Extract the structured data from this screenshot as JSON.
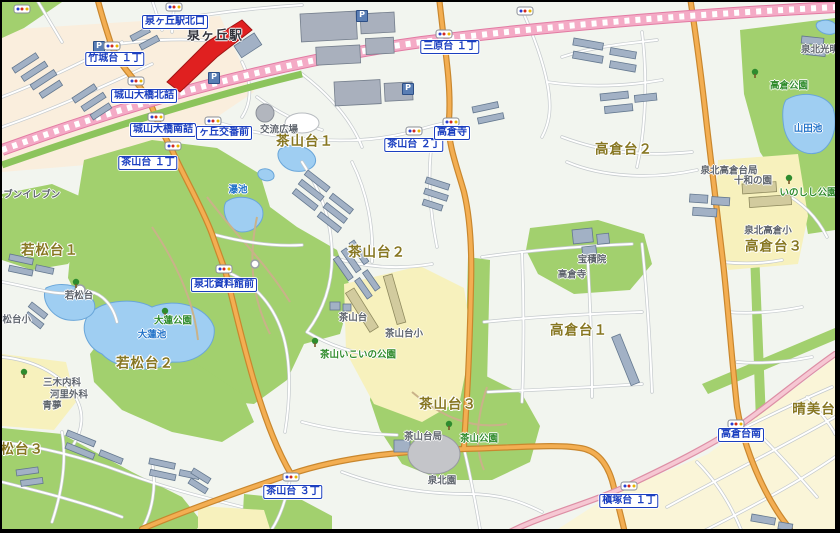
{
  "map": {
    "colors": {
      "label_blue": "#1b3fc0",
      "district_olive": "#877722",
      "park_green": "#2f8b2b",
      "water_blue": "#2273c9",
      "road_orange": "#f3ae52",
      "rail_pink": "#f4abc6",
      "station_red": "#e02020"
    },
    "parking_glyph": "P",
    "stations": [
      {
        "t": "泉ヶ丘駅",
        "x": 213,
        "y": 34
      }
    ],
    "intersections": [
      {
        "t": "泉ヶ丘駅北口",
        "x": 173,
        "y": 20
      },
      {
        "t": "竹城台 １丁",
        "x": 113,
        "y": 57
      },
      {
        "t": "城山大橋北詰",
        "x": 142,
        "y": 94
      },
      {
        "t": "城山大橋南詰",
        "x": 161,
        "y": 128
      },
      {
        "t": "ヶ丘交番前",
        "x": 222,
        "y": 131
      },
      {
        "t": "茶山台 １丁",
        "x": 146,
        "y": 161
      },
      {
        "t": "三原台 １丁",
        "x": 448,
        "y": 45
      },
      {
        "t": "茶山台 ２丁",
        "x": 412,
        "y": 143
      },
      {
        "t": "高倉寺",
        "x": 450,
        "y": 131
      },
      {
        "t": "泉北資料館前",
        "x": 222,
        "y": 283
      },
      {
        "t": "茶山台 ３丁",
        "x": 291,
        "y": 490
      },
      {
        "t": "槇塚台 １丁",
        "x": 627,
        "y": 499
      },
      {
        "t": "高倉台南",
        "x": 739,
        "y": 433
      }
    ],
    "signals": [
      {
        "x": 20,
        "y": 7
      },
      {
        "x": 172,
        "y": 5
      },
      {
        "x": 110,
        "y": 44
      },
      {
        "x": 134,
        "y": 79
      },
      {
        "x": 154,
        "y": 115
      },
      {
        "x": 211,
        "y": 119
      },
      {
        "x": 171,
        "y": 144
      },
      {
        "x": 442,
        "y": 32
      },
      {
        "x": 523,
        "y": 9
      },
      {
        "x": 412,
        "y": 129
      },
      {
        "x": 449,
        "y": 120
      },
      {
        "x": 222,
        "y": 267
      },
      {
        "x": 289,
        "y": 475
      },
      {
        "x": 627,
        "y": 484
      },
      {
        "x": 734,
        "y": 422
      }
    ],
    "districts": [
      {
        "t": "茶山台１",
        "x": 303,
        "y": 140
      },
      {
        "t": "茶山台２",
        "x": 375,
        "y": 251
      },
      {
        "t": "茶山台３",
        "x": 446,
        "y": 403
      },
      {
        "t": "高倉台２",
        "x": 622,
        "y": 148
      },
      {
        "t": "高倉台１",
        "x": 577,
        "y": 329
      },
      {
        "t": "高倉台３",
        "x": 772,
        "y": 245
      },
      {
        "t": "若松台１",
        "x": 48,
        "y": 249
      },
      {
        "t": "若松台２",
        "x": 143,
        "y": 362
      },
      {
        "t": "若松台３",
        "x": 13,
        "y": 448
      },
      {
        "t": "晴美台",
        "x": 812,
        "y": 408
      }
    ],
    "facilities": [
      {
        "t": "交流広場",
        "x": 277,
        "y": 128
      },
      {
        "t": "泉北高倉台局",
        "x": 727,
        "y": 169
      },
      {
        "t": "十和の園",
        "x": 751,
        "y": 179
      },
      {
        "t": "泉北高倉小",
        "x": 766,
        "y": 229
      },
      {
        "t": "泉北光明",
        "x": 818,
        "y": 48
      },
      {
        "t": "宝積院",
        "x": 590,
        "y": 258
      },
      {
        "t": "高倉寺",
        "x": 570,
        "y": 273
      },
      {
        "t": "茶山台小",
        "x": 402,
        "y": 332
      },
      {
        "t": "茶山台",
        "x": 351,
        "y": 316
      },
      {
        "t": "茶山台局",
        "x": 421,
        "y": 435
      },
      {
        "t": "泉北園",
        "x": 440,
        "y": 479
      },
      {
        "t": "若松台",
        "x": 77,
        "y": 294
      },
      {
        "t": "若松台小",
        "x": 10,
        "y": 318
      },
      {
        "t": "三木内科",
        "x": 60,
        "y": 381
      },
      {
        "t": "河里外科",
        "x": 67,
        "y": 393
      },
      {
        "t": "青夢",
        "x": 50,
        "y": 404
      },
      {
        "t": "セブンイレブン",
        "x": 25,
        "y": 193
      }
    ],
    "parks": [
      {
        "t": "高倉公園",
        "x": 787,
        "y": 84
      },
      {
        "t": "いのしし公園",
        "x": 806,
        "y": 191
      },
      {
        "t": "大蓮公園",
        "x": 171,
        "y": 319
      },
      {
        "t": "茶山公園",
        "x": 477,
        "y": 437
      },
      {
        "t": "茶山いこいの公園",
        "x": 356,
        "y": 353
      }
    ],
    "waters": [
      {
        "t": "山田池",
        "x": 806,
        "y": 127
      },
      {
        "t": "大蓮池",
        "x": 150,
        "y": 333
      },
      {
        "t": "瀑池",
        "x": 236,
        "y": 188
      }
    ],
    "parkings": [
      {
        "x": 97,
        "y": 45
      },
      {
        "x": 212,
        "y": 76
      },
      {
        "x": 360,
        "y": 14
      },
      {
        "x": 406,
        "y": 87
      }
    ]
  }
}
